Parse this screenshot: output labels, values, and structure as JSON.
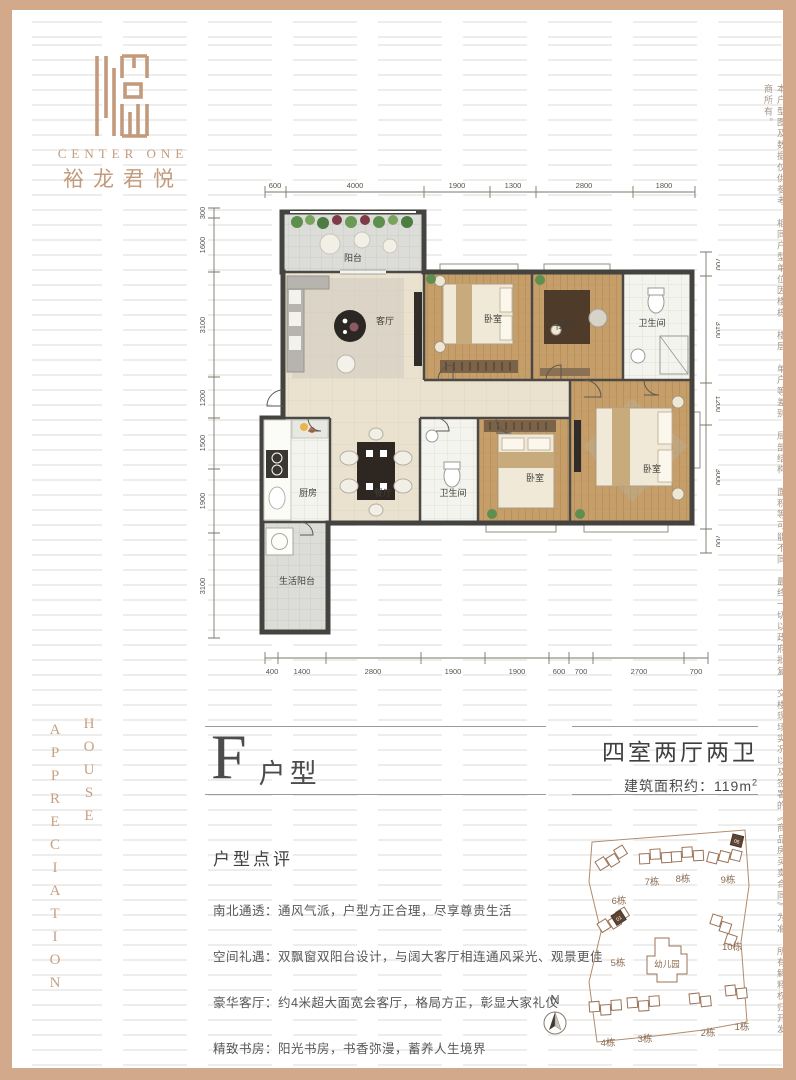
{
  "brand": {
    "name_en": "CENTER ONE",
    "name_cn": "裕龙君悦"
  },
  "unit_info": {
    "letter": "F",
    "type_label": "户型",
    "rooms_desc": "四室两厅两卫",
    "area_label": "建筑面积约：",
    "area_value": "119m",
    "area_sup": "2"
  },
  "review": {
    "title": "户型点评",
    "items": [
      "南北通透：通风气派，户型方正合理，尽享尊贵生活",
      "空间礼遇：双飘窗双阳台设计，与阔大客厅相连通风采光、观景更佳",
      "豪华客厅：约4米超大面宽会客厅，格局方正，彰显大家礼仪",
      "精致书房：阳光书房，书香弥漫，蓄养人生境界"
    ]
  },
  "floorplan": {
    "rooms": {
      "balcony": "阳台",
      "living": "客厅",
      "bedroom": "卧室",
      "study": "书房",
      "bath": "卫生间",
      "kitchen": "厨房",
      "dining": "餐厅",
      "utility_balcony": "生活阳台"
    },
    "dims_top": [
      "600",
      "4000",
      "1900",
      "1300",
      "2800",
      "1800"
    ],
    "dims_bottom": [
      "400",
      "1400",
      "2800",
      "1900",
      "1900",
      "600",
      "700",
      "2700",
      "700"
    ],
    "dims_left": [
      "300",
      "1600",
      "3100",
      "1200",
      "1500",
      "1900",
      "3100"
    ],
    "dims_right": [
      "700",
      "3100",
      "1200",
      "3000",
      "700"
    ]
  },
  "siteplan": {
    "north_label": "N",
    "kindergarten": "幼儿园",
    "buildings": [
      "1栋",
      "2栋",
      "3栋",
      "4栋",
      "5栋",
      "6栋",
      "7栋",
      "8栋",
      "9栋",
      "10栋"
    ],
    "highlighted_units": [
      "05",
      "01"
    ]
  },
  "side_texts": {
    "left_word_1": "HOUSE",
    "left_word_2": "APPRECIATION",
    "right_disclaimer": "本户型图及数据仅供参考，相同户型单位因楼栋、楼层、单户等差别，局部结构、面积等可能不同，最终一切以政府批复、交楼现场实况以及签署的《商品房买卖合同》为准，所有解释权归开发商所有。"
  },
  "colors": {
    "frame": "#d3a98b",
    "brand_tan": "#c49a7c",
    "wood_floor": "#c69e6a",
    "wall": "#45433f"
  }
}
